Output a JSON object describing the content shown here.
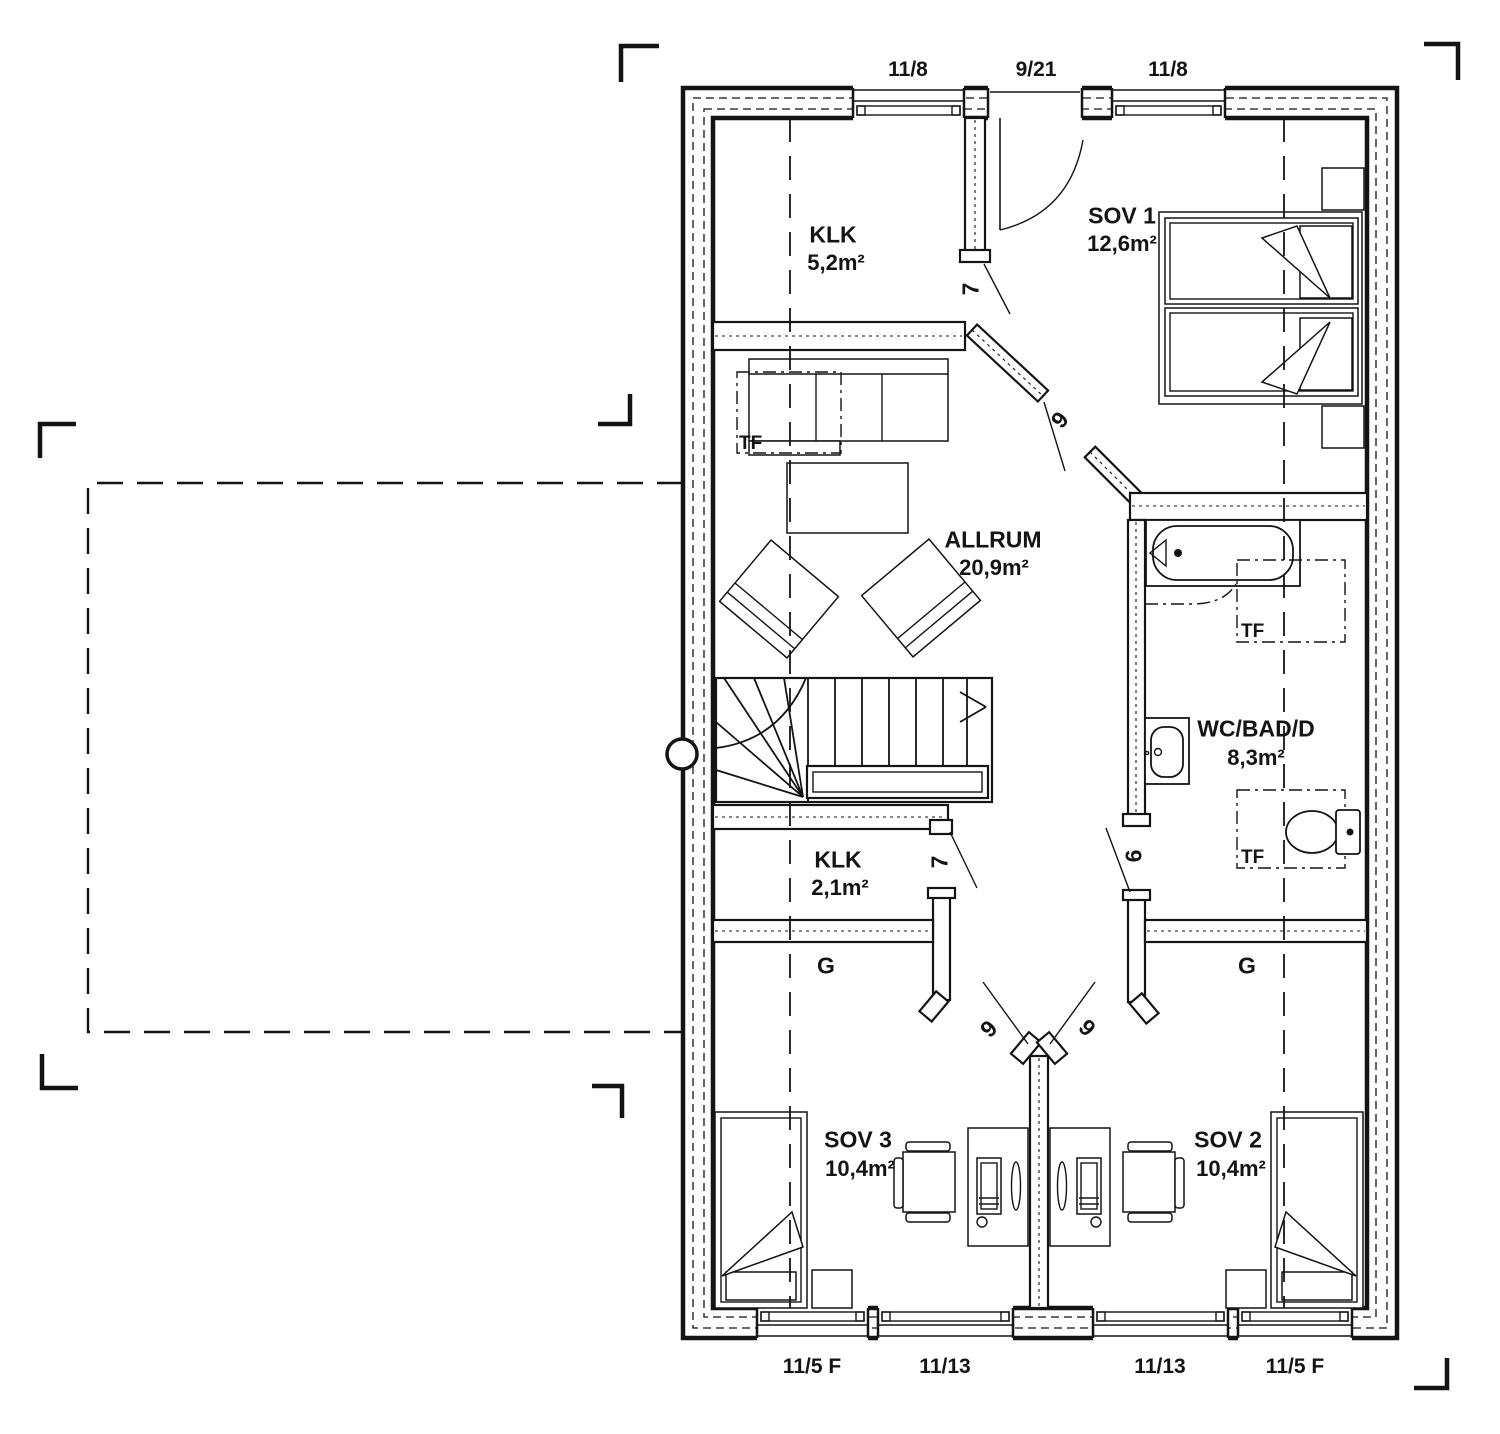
{
  "plan": {
    "rooms": {
      "klk1": {
        "name": "KLK",
        "area": "5,2m²"
      },
      "sov1": {
        "name": "SOV 1",
        "area": "12,6m²"
      },
      "allrum": {
        "name": "ALLRUM",
        "area": "20,9m²"
      },
      "wc_bad_d": {
        "name": "WC/BAD/D",
        "area": "8,3m²"
      },
      "klk2": {
        "name": "KLK",
        "area": "2,1m²"
      },
      "sov3": {
        "name": "SOV 3",
        "area": "10,4m²"
      },
      "sov2": {
        "name": "SOV 2",
        "area": "10,4m²"
      }
    },
    "closets": {
      "left": "G",
      "right": "G"
    },
    "skylights": {
      "allrum": "TF",
      "bath_upper": "TF",
      "bath_lower": "TF"
    },
    "top_openings": [
      {
        "label": "11/8"
      },
      {
        "label": "9/21"
      },
      {
        "label": "11/8"
      }
    ],
    "bottom_openings": [
      {
        "label": "11/5 F"
      },
      {
        "label": "11/13"
      },
      {
        "label": "11/13"
      },
      {
        "label": "11/5 F"
      }
    ],
    "door_numbers": {
      "sov1_door": "7",
      "allrum_door": "9",
      "bath_door": "6",
      "klk2_door": "7",
      "sov3_door": "9",
      "sov2_door": "9"
    },
    "colors": {
      "ink": "#141414",
      "background": "#ffffff"
    }
  }
}
